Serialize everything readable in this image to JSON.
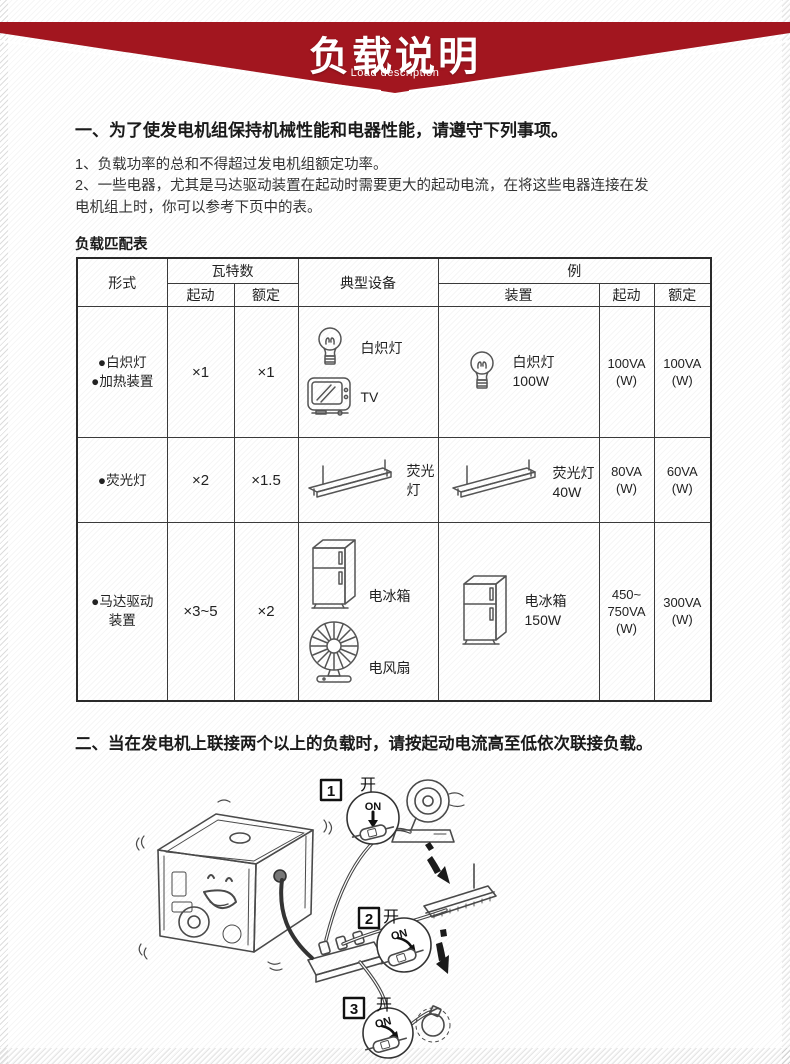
{
  "banner": {
    "title": "负载说明",
    "subtitle": "Load description",
    "color": "#a2161f"
  },
  "sections": {
    "s1_heading": "一、为了使发电机组保持机械性能和电器性能，请遵守下列事项。",
    "s1_item1": "1、负载功率的总和不得超过发电机组额定功率。",
    "s1_item2a": "2、一些电器，尤其是马达驱动装置在起动时需要更大的起动电流，在将这些电器连接在发",
    "s1_item2b": "电机组上时，你可以参考下页中的表。",
    "s2_heading": "二、当在发电机上联接两个以上的负载时，请按起动电流高至低依次联接负载。"
  },
  "table": {
    "title": "负载匹配表",
    "headers": {
      "form": "形式",
      "wattage": "瓦特数",
      "start": "起动",
      "rated": "额定",
      "typical": "典型设备",
      "example": "例",
      "device": "装置"
    },
    "rows": [
      {
        "form1": "●白炽灯",
        "form2": "●加热装置",
        "start": "×1",
        "rated": "×1",
        "t1": "白炽灯",
        "t2": "TV",
        "d1": "白炽灯",
        "d2": "100W",
        "es1": "100VA",
        "es2": "(W)",
        "er1": "100VA",
        "er2": "(W)"
      },
      {
        "form1": "●荧光灯",
        "start": "×2",
        "rated": "×1.5",
        "t1": "荧光灯",
        "d1": "荧光灯",
        "d2": "40W",
        "es1": "80VA",
        "es2": "(W)",
        "er1": "60VA",
        "er2": "(W)"
      },
      {
        "form1": "●马达驱动",
        "form2": "装置",
        "start": "×3~5",
        "rated": "×2",
        "t1": "电冰箱",
        "t2": "电风扇",
        "d1": "电冰箱",
        "d2": "150W",
        "es1": "450~",
        "es2": "750VA",
        "es3": "(W)",
        "er1": "300VA",
        "er2": "(W)"
      }
    ]
  },
  "illustration": {
    "step1": {
      "num": "1",
      "kai": "开",
      "on": "ON"
    },
    "step2": {
      "num": "2",
      "kai": "开",
      "on": "ON"
    },
    "step3": {
      "num": "3",
      "kai": "开",
      "on": "ON"
    }
  },
  "icons": {
    "table": [
      "incandescent-bulb-icon",
      "tv-icon",
      "fluorescent-tube-icon",
      "refrigerator-icon",
      "electric-fan-icon"
    ],
    "illustration": [
      "generator-icon",
      "power-strip-icon",
      "spotlight-icon",
      "ceiling-light-icon",
      "hanging-bulb-icon",
      "inline-switch-icon",
      "sequence-arrow-icon"
    ]
  }
}
